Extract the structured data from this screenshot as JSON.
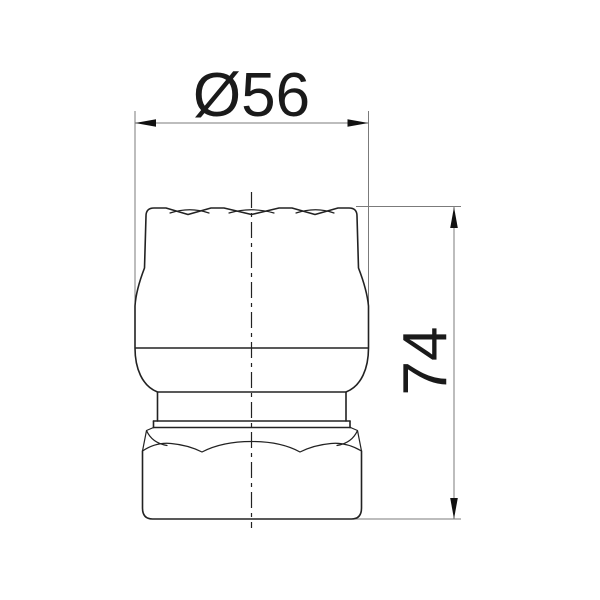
{
  "drawing": {
    "type": "technical-dimension-drawing",
    "part": "faucet-cap-fitting-front-view",
    "labels": {
      "diameter": "Ø56",
      "height": "74"
    },
    "values": {
      "diameter": 56,
      "height": 74
    },
    "colors": {
      "background": "#ffffff",
      "outline": "#222222",
      "dimension_line": "#7b7b7b",
      "arrowhead": "#111111",
      "text": "#1a1a1a"
    }
  }
}
